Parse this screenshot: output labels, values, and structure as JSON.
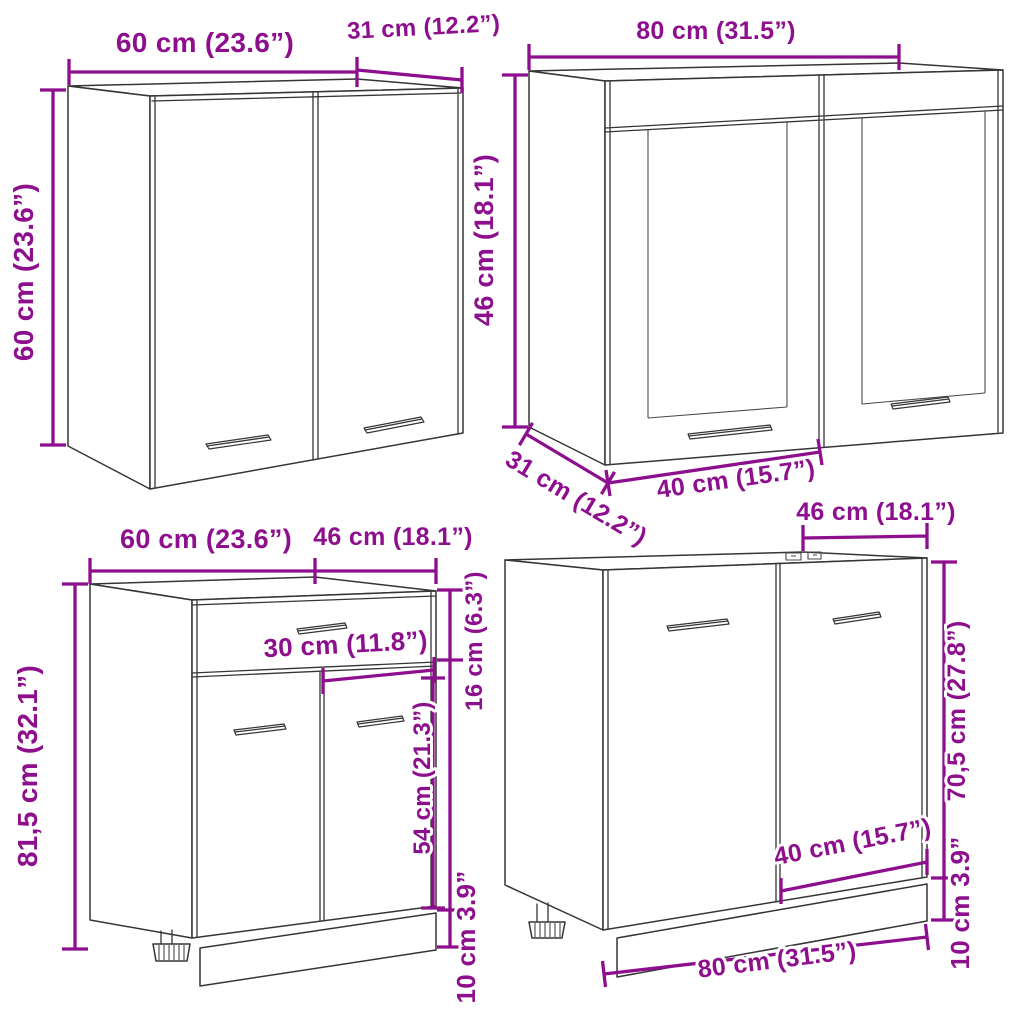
{
  "figure": {
    "kind": "kitchen cabinet set dimension diagram",
    "accent_color": "#8E0F8E",
    "line_color": "#353535",
    "background_color": "#FFFFFF"
  },
  "cabinets": {
    "wall_cabinet": {
      "name": "wall cabinet with two doors",
      "width": "60 cm (23.6”)",
      "depth": "31 cm (12.2”)",
      "height": "60 cm (23.6”)"
    },
    "wall_glass_cabinet": {
      "name": "hanging glass cabinet",
      "width": "80 cm (31.5”)",
      "height": "46 cm (18.1”)",
      "depth": "31 cm (12.2”)",
      "door_width": "40 cm (15.7”)"
    },
    "base_drawer_cabinet": {
      "name": "bottom cabinet with drawer",
      "width": "60 cm (23.6”)",
      "depth": "46 cm (18.1”)",
      "height": "81,5 cm (32.1”)",
      "drawer_front_height": "16 cm (6.3”)",
      "half_width": "30 cm (11.8”)",
      "door_height": "54 cm (21.3”)",
      "plinth_height": "10 cm 3.9”"
    },
    "sink_base_cabinet": {
      "name": "sink bottom cabinet",
      "depth": "46 cm (18.1”)",
      "height": "70,5 cm (27.8”)",
      "door_width": "40 cm (15.7”)",
      "plinth_height": "10 cm 3.9”",
      "width": "80 cm (31.5”)"
    }
  }
}
